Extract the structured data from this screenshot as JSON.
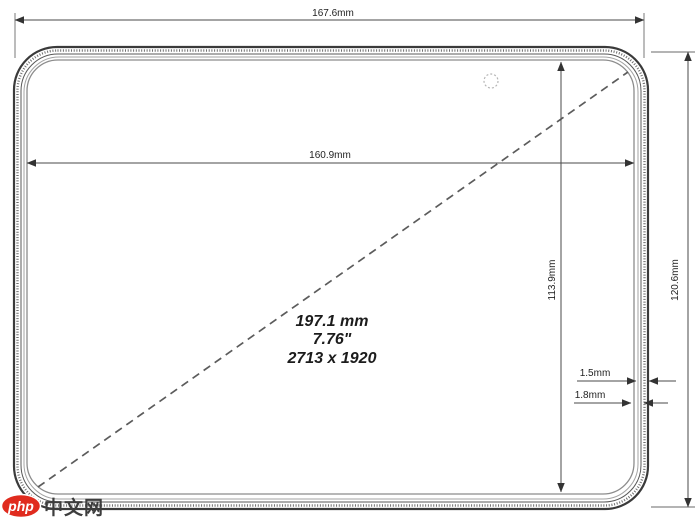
{
  "drawing": {
    "overall_width_label": "167.6mm",
    "display_width_label": "160.9mm",
    "display_height_label": "113.9mm",
    "overall_height_label": "120.6mm",
    "edge_label_1": "1.5mm",
    "edge_label_2": "1.8mm",
    "diagonal": {
      "mm": "197.1 mm",
      "inches": "7.76\"",
      "resolution": "2713 x 1920"
    },
    "colors": {
      "line": "#4a4a4a",
      "text": "#1f1f1f",
      "background": "#ffffff"
    }
  },
  "watermark": {
    "badge": "php",
    "text": "中文网",
    "badge_color": "#e02b1e"
  }
}
